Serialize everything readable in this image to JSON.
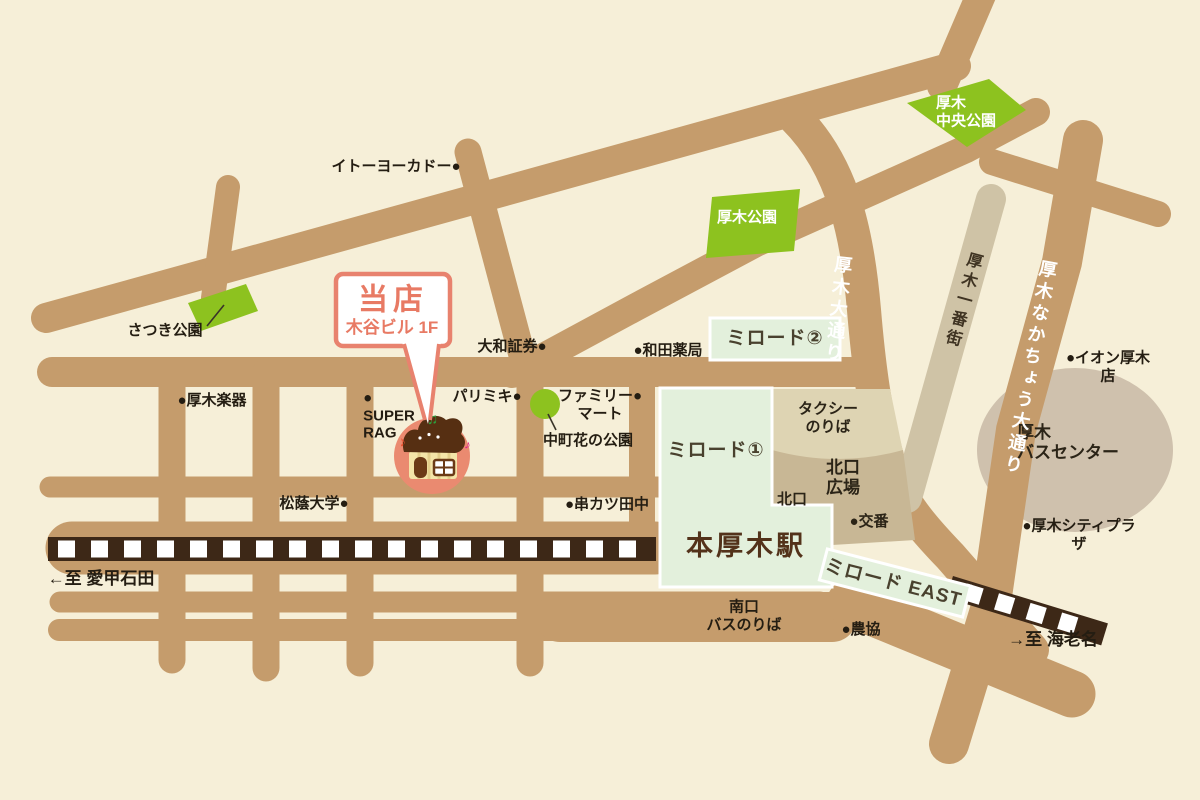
{
  "map": {
    "colors": {
      "background": "#f6efd8",
      "road": "#c59c6c",
      "road_light": "#cfc3a6",
      "railway": "#3d2817",
      "park_green": "#8dc21f",
      "station_green": "#e3f0dc",
      "plaza_tan": "#c8b795",
      "taxi_tan": "#ded4b3",
      "bus_blob": "#cfc1ad",
      "accent_salmon": "#e8826e",
      "station_text": "#53321a"
    },
    "callout": {
      "line1": "当店",
      "line2": "木谷ビル 1F"
    },
    "labels": [
      {
        "name": "label-ito-yokado",
        "text": "イトーヨーカドー●",
        "x": 396,
        "y": 167,
        "cls": ""
      },
      {
        "name": "label-satsuki-park",
        "text": "さつき公園",
        "x": 165,
        "y": 331,
        "cls": ""
      },
      {
        "name": "label-daiwa-shoken",
        "text": "大和証券●",
        "x": 512,
        "y": 347,
        "cls": ""
      },
      {
        "name": "label-wada-yakkyoku",
        "text": "●和田薬局",
        "x": 668,
        "y": 351,
        "cls": ""
      },
      {
        "name": "label-atsugi-gakki",
        "text": "●厚木楽器",
        "x": 212,
        "y": 401,
        "cls": ""
      },
      {
        "name": "label-super-rag",
        "text": [
          "●",
          "SUPER",
          "RAG"
        ],
        "x": 389,
        "y": 416,
        "cls": "ta-left"
      },
      {
        "name": "label-paris-miki",
        "text": "パリミキ●",
        "x": 487,
        "y": 397,
        "cls": ""
      },
      {
        "name": "label-family-mart",
        "text": [
          "ファミリー●",
          "マート"
        ],
        "x": 600,
        "y": 405,
        "cls": ""
      },
      {
        "name": "label-nakacho-hana-park",
        "text": "中町花の公園",
        "x": 588,
        "y": 441,
        "cls": ""
      },
      {
        "name": "label-shoin-univ",
        "text": "松蔭大学●",
        "x": 314,
        "y": 504,
        "cls": ""
      },
      {
        "name": "label-kushikatsu-tanaka",
        "text": "●串カツ田中",
        "x": 607,
        "y": 505,
        "cls": ""
      },
      {
        "name": "label-to-aikoishida",
        "text": "←至 愛甲石田",
        "x": 101,
        "y": 579,
        "cls": "dir"
      },
      {
        "name": "label-minamiguchi-bus",
        "text": [
          "南口",
          "バスのりば"
        ],
        "x": 744,
        "y": 616,
        "cls": ""
      },
      {
        "name": "label-nokyo",
        "text": "●農協",
        "x": 861,
        "y": 630,
        "cls": ""
      },
      {
        "name": "label-to-ebina",
        "text": "→至 海老名",
        "x": 1053,
        "y": 640,
        "cls": "dir"
      },
      {
        "name": "label-koban",
        "text": "●交番",
        "x": 869,
        "y": 522,
        "cls": "plaza"
      },
      {
        "name": "label-kitaguchi",
        "text": "北口",
        "x": 792,
        "y": 500,
        "cls": "plaza"
      },
      {
        "name": "label-kitaguchi-hiroba",
        "text": [
          "北口",
          "広場"
        ],
        "x": 843,
        "y": 478,
        "cls": "plaza-lg"
      },
      {
        "name": "label-taxi-noriba",
        "text": [
          "タクシー",
          "のりば"
        ],
        "x": 828,
        "y": 418,
        "cls": "plaza"
      },
      {
        "name": "label-aeon-atsugi",
        "text": "●イオン厚木店",
        "x": 1108,
        "y": 367,
        "cls": ""
      },
      {
        "name": "label-atsugi-bus-center",
        "text": [
          "厚木",
          "バスセンター"
        ],
        "x": 1068,
        "y": 443,
        "cls": "ta-left plaza-lg"
      },
      {
        "name": "label-atsugi-city-plaza",
        "text": "●厚木シティプラザ",
        "x": 1079,
        "y": 535,
        "cls": ""
      },
      {
        "name": "label-miload2",
        "text": "ミロード②",
        "x": 775,
        "y": 339,
        "cls": "miload"
      },
      {
        "name": "label-miload1",
        "text": "ミロード①",
        "x": 716,
        "y": 451,
        "cls": "miload"
      },
      {
        "name": "label-honatsugi-station",
        "text": "本厚木駅",
        "x": 746,
        "y": 547,
        "cls": "station-big"
      },
      {
        "name": "label-miload-east",
        "text": "ミロード EAST",
        "x": 893,
        "y": 584,
        "cls": "miload",
        "rot": 14.5
      },
      {
        "name": "label-atsugi-park",
        "text": "厚木公園",
        "x": 747,
        "y": 218,
        "cls": "white"
      },
      {
        "name": "label-atsugi-chuo-park",
        "text": [
          "厚木",
          "中央公園"
        ],
        "x": 966,
        "y": 112,
        "cls": "white ta-left"
      },
      {
        "name": "label-callout-main",
        "text": "当店",
        "x": 393,
        "y": 300,
        "cls": "callout-main"
      },
      {
        "name": "label-callout-sub",
        "text": "木谷ビル 1F",
        "x": 392,
        "y": 328,
        "cls": "callout-sub"
      },
      {
        "name": "label-atsugi-odori",
        "text": "厚木大通り",
        "x": 837,
        "y": 310,
        "cls": "road-v white",
        "rot": 6
      },
      {
        "name": "label-atsugi-ichibangai",
        "text": "厚木一番街",
        "x": 961,
        "y": 300,
        "cls": "road-v road-v-dark",
        "rot": 15
      },
      {
        "name": "label-atsugi-nakacho-odori",
        "text": "厚木なかちょう大通り",
        "x": 1029,
        "y": 368,
        "cls": "road-v white",
        "rot": 10
      }
    ]
  }
}
